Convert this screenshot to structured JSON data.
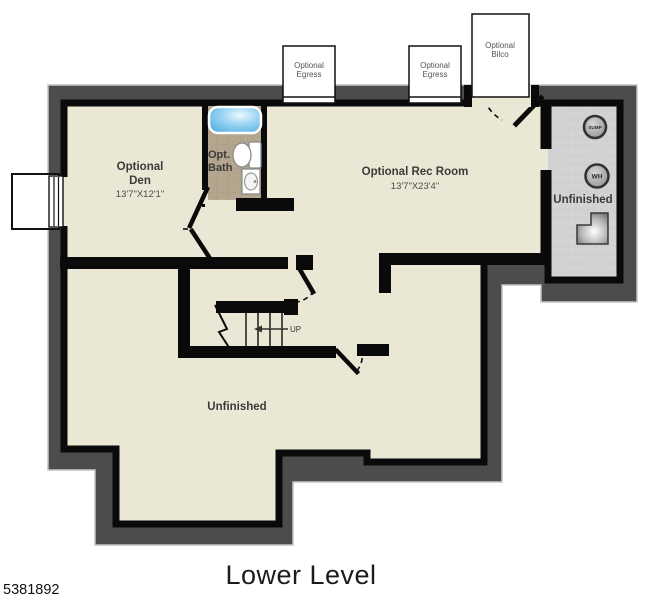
{
  "title": "Lower Level",
  "photo_id": "5381892",
  "rooms": {
    "den": {
      "name_line1": "Optional",
      "name_line2": "Den",
      "dims": "13'7\"X12'1\""
    },
    "bath": {
      "name_line1": "Opt.",
      "name_line2": "Bath"
    },
    "rec": {
      "name": "Optional Rec Room",
      "dims": "13'7\"X23'4\""
    },
    "unfinished_lower": {
      "name": "Unfinished"
    },
    "unfinished_utility": {
      "name": "Unfinished"
    }
  },
  "annotations": {
    "egress1": {
      "line1": "Optional",
      "line2": "Egress"
    },
    "egress2": {
      "line1": "Optional",
      "line2": "Egress"
    },
    "bilco": {
      "line1": "Optional",
      "line2": "Bilco"
    },
    "stairs_up": "UP",
    "sump": "SUMP",
    "water_heater": "WH"
  },
  "colors": {
    "outer_wall": "#4c4c4c",
    "inner_wall": "#0a0a0a",
    "floor_cream": "#eae8d5",
    "floor_utility": "#d2d2d2",
    "floor_tile": "#b4a58e",
    "tub_blue": "#6fc0ea",
    "background": "#ffffff"
  }
}
